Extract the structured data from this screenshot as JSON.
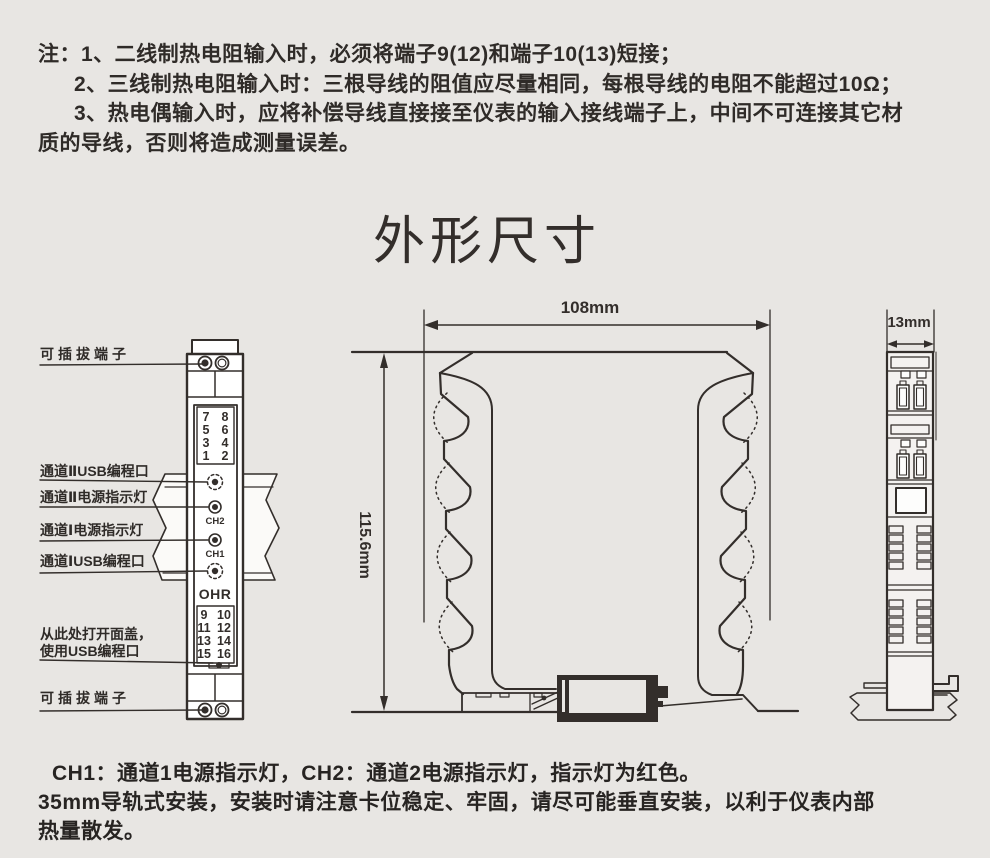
{
  "page": {
    "bg": "#e8e6e3",
    "ink": "#332e2b",
    "white": "#ffffff"
  },
  "notes": {
    "lines": [
      "注：1、二线制热电阻输入时，必须将端子9(12)和端子10(13)短接；",
      "2、三线制热电阻输入时：三根导线的阻值应尽量相同，每根导线的电阻不能超过10Ω；",
      "3、热电偶输入时，应将补偿导线直接接至仪表的输入接线端子上，中间不可连接其它材",
      "质的导线，否则将造成测量误差。"
    ]
  },
  "title": "外形尺寸",
  "front_view": {
    "callouts": {
      "terminal_top": "可插拔端子",
      "ch2_usb": "通道ⅡUSB编程口",
      "ch2_led": "通道Ⅱ电源指示灯",
      "ch1_led": "通道Ⅰ电源指示灯",
      "ch1_usb": "通道ⅠUSB编程口",
      "open_cover_1": "从此处打开面盖，",
      "open_cover_2": "使用USB编程口",
      "terminal_bottom": "可插拔端子"
    },
    "terminals_top": [
      "7",
      "8",
      "5",
      "6",
      "3",
      "4",
      "1",
      "2"
    ],
    "terminals_bottom": [
      "9",
      "10",
      "11",
      "12",
      "13",
      "14",
      "15",
      "16"
    ],
    "led_ch2": "CH2",
    "led_ch1": "CH1",
    "brand": "OHR"
  },
  "dimensions": {
    "width": "108mm",
    "height": "115.6mm",
    "depth": "13mm"
  },
  "footer": {
    "lines": [
      "CH1：通道1电源指示灯，CH2：通道2电源指示灯，指示灯为红色。",
      "35mm导轨式安装，安装时请注意卡位稳定、牢固，请尽可能垂直安装，以利于仪表内部",
      "热量散发。"
    ]
  }
}
